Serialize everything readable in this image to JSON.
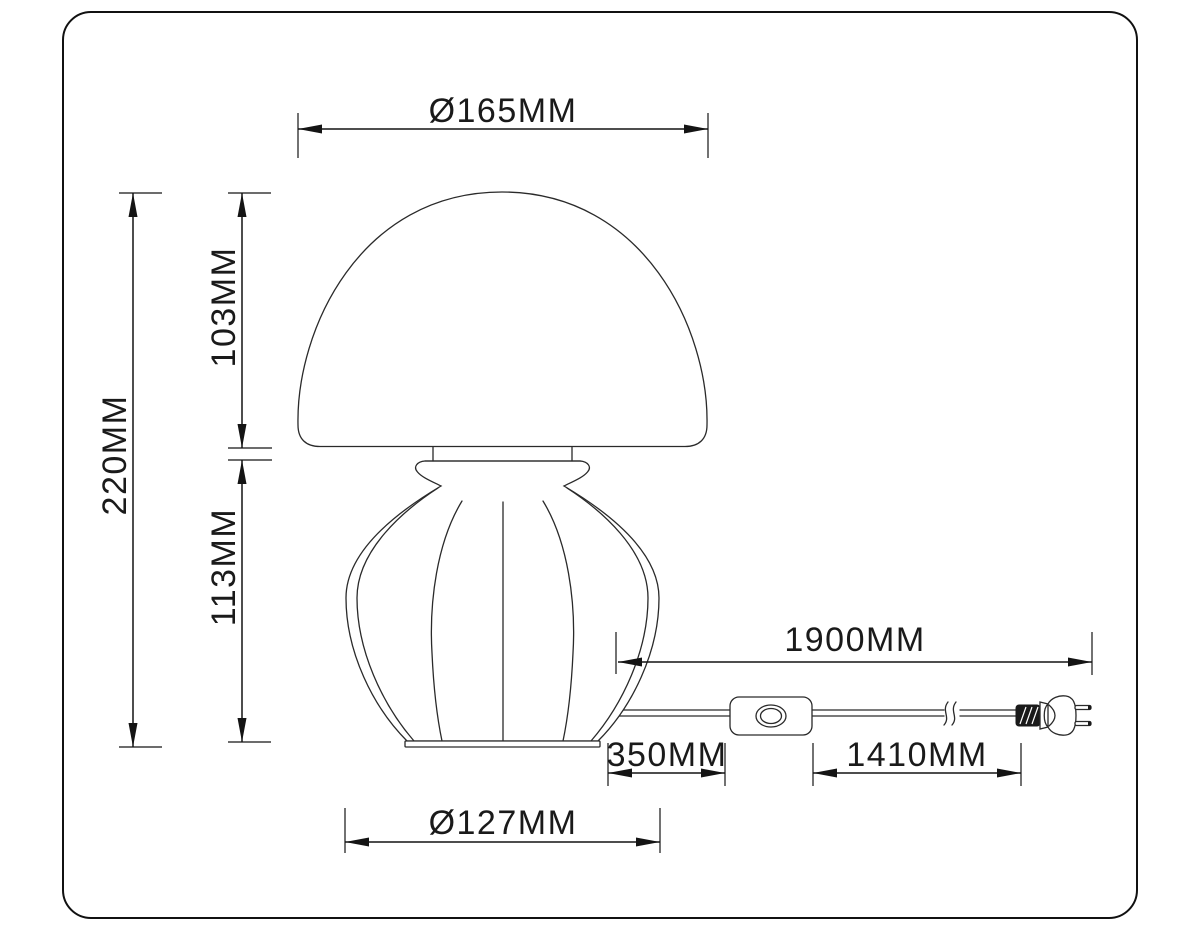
{
  "dimensions": {
    "shade_diameter": "Ø165MM",
    "total_height": "220MM",
    "shade_height": "103MM",
    "base_height": "113MM",
    "cord_length": "1900MM",
    "base_to_switch": "350MM",
    "switch_to_plug": "1410MM",
    "base_diameter": "Ø127MM"
  },
  "colors": {
    "outline": "#2a2a2a",
    "dimension_line": "#141414",
    "text": "#1a1a1a",
    "background": "#ffffff"
  }
}
